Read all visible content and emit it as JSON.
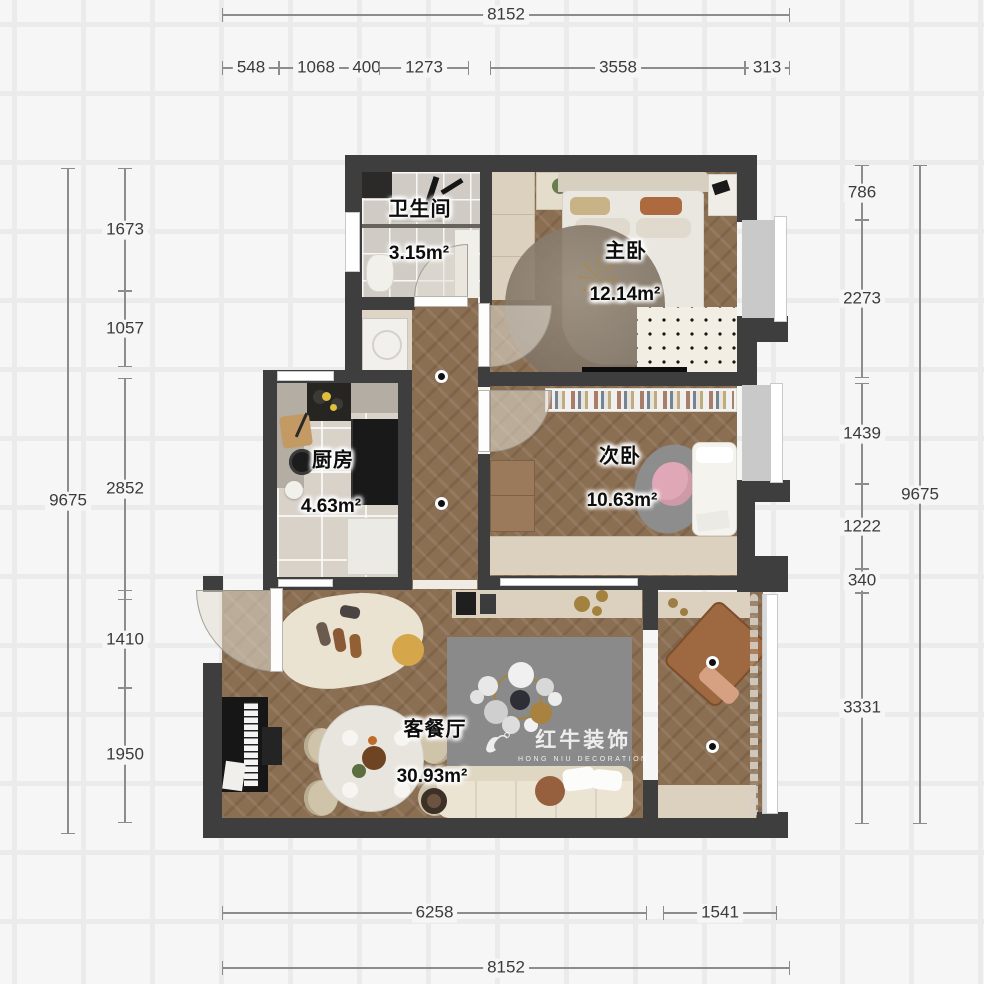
{
  "plan": {
    "rooms": [
      {
        "name": "卫生间",
        "area": "3.15m²"
      },
      {
        "name": "主卧",
        "area": "12.14m²"
      },
      {
        "name": "次卧",
        "area": "10.63m²"
      },
      {
        "name": "厨房",
        "area": "4.63m²"
      },
      {
        "name": "客餐厅",
        "area": "30.93m²"
      }
    ],
    "dimensions": {
      "top_total": "8152",
      "top_segments": [
        "548",
        "1068",
        "400",
        "1273",
        "3558",
        "313"
      ],
      "left_total": "9675",
      "left_segments": [
        "1673",
        "1057",
        "2852",
        "1410",
        "1950"
      ],
      "right_total": "9675",
      "right_segments": [
        "786",
        "2273",
        "1439",
        "1222",
        "340",
        "3331"
      ],
      "bottom_segments": [
        "6258",
        "1541"
      ],
      "bottom_total": "8152"
    },
    "watermark": {
      "brand": "红牛装饰",
      "sub": "HONG NIU DECORATION"
    },
    "colors": {
      "wall": "#3e3e3e",
      "wood_floor": "#8b6f53",
      "dim_line": "#8c8c8c",
      "background": "#f6f6f6"
    }
  }
}
